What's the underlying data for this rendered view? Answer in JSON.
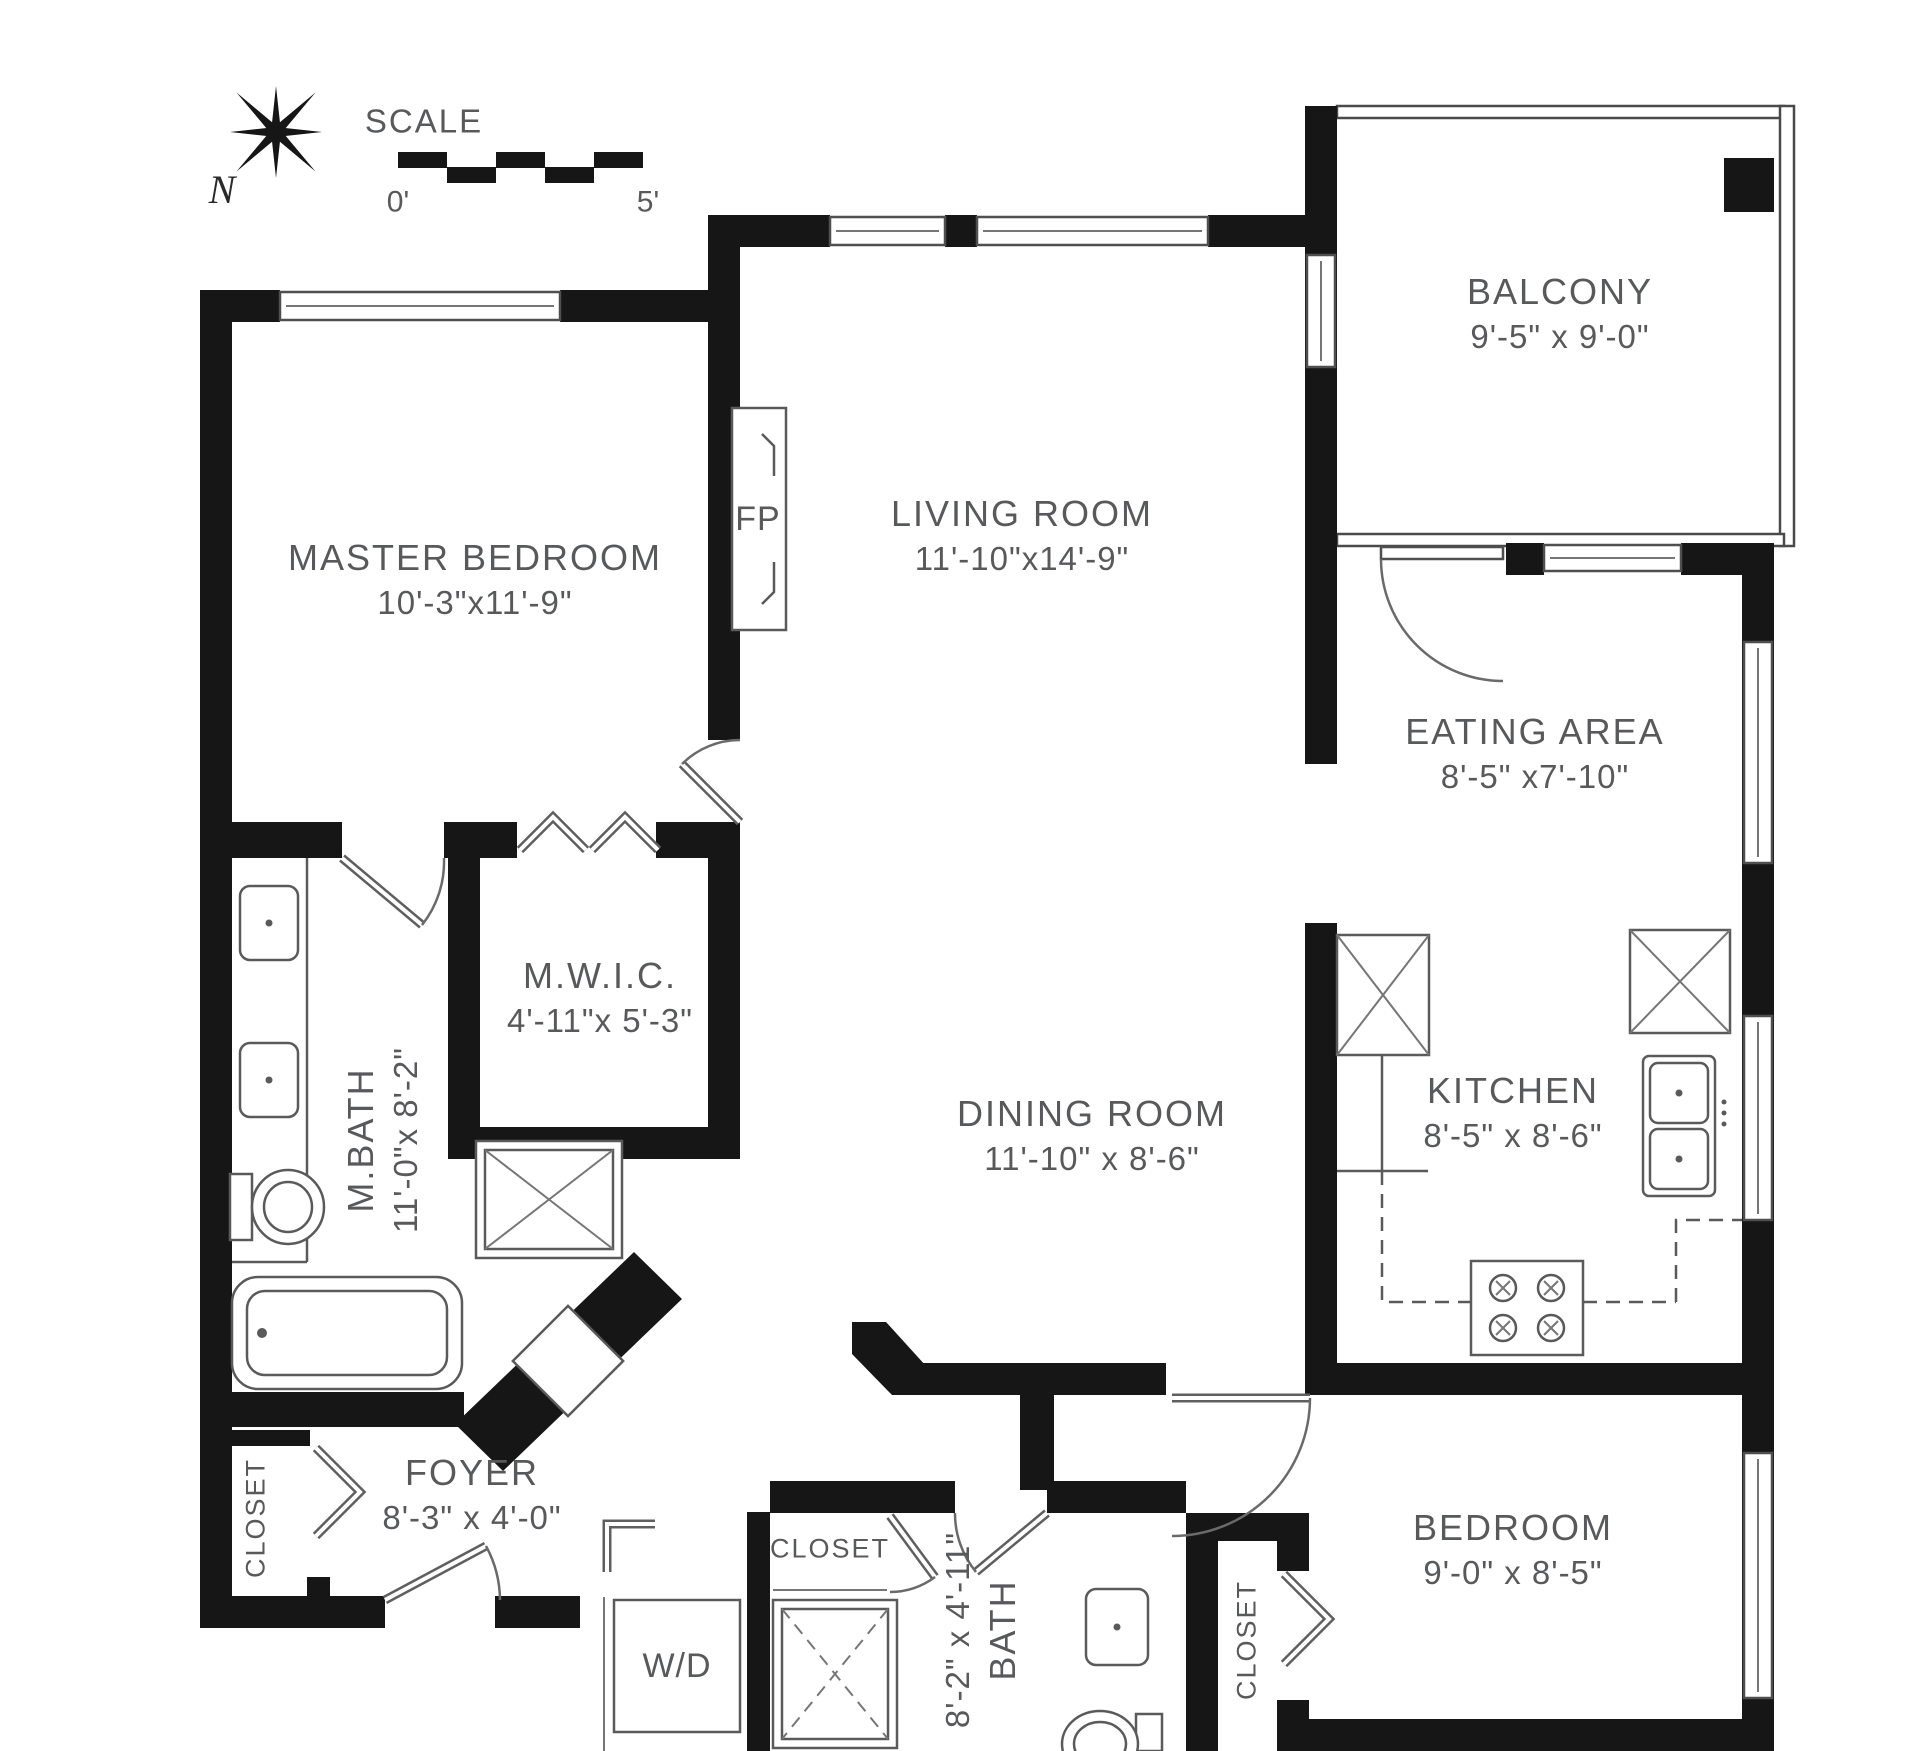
{
  "compass": {
    "north": "N"
  },
  "scale": {
    "title": "SCALE",
    "zero": "0'",
    "five": "5'"
  },
  "rooms": {
    "master_bedroom": {
      "name": "MASTER BEDROOM",
      "dims": "10'-3\"x11'-9\""
    },
    "living_room": {
      "name": "LIVING ROOM",
      "dims": "11'-10\"x14'-9\""
    },
    "balcony": {
      "name": "BALCONY",
      "dims": "9'-5\" x 9'-0\""
    },
    "eating_area": {
      "name": "EATING AREA",
      "dims": "8'-5\" x7'-10\""
    },
    "mwic": {
      "name": "M.W.I.C.",
      "dims": "4'-11\"x 5'-3\""
    },
    "master_bath": {
      "name": "M.BATH",
      "dims": "11'-0\"x 8'-2\""
    },
    "dining_room": {
      "name": "DINING ROOM",
      "dims": "11'-10\" x 8'-6\""
    },
    "kitchen": {
      "name": "KITCHEN",
      "dims": "8'-5\" x 8'-6\""
    },
    "foyer": {
      "name": "FOYER",
      "dims": "8'-3\" x 4'-0\""
    },
    "bath": {
      "name": "BATH",
      "dims": "8'-2\" x 4'-11\""
    },
    "bedroom": {
      "name": "BEDROOM",
      "dims": "9'-0\" x 8'-5\""
    }
  },
  "labels": {
    "closet": "CLOSET",
    "washer_dryer": "W/D",
    "fireplace": "FP"
  }
}
